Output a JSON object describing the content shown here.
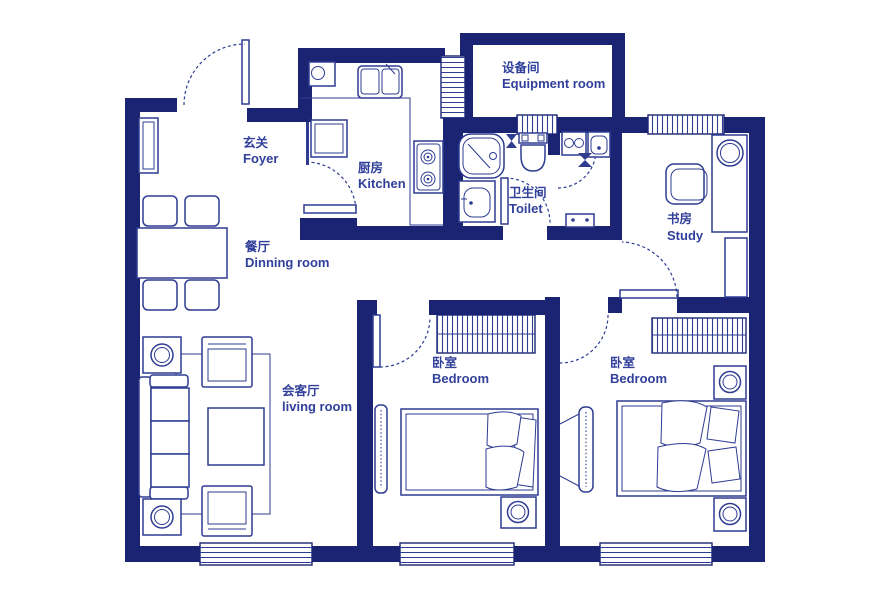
{
  "title": "apartment floor plan",
  "palette": {
    "wall": "#1a2472",
    "line": "#2e3c92",
    "text": "#31409a",
    "bg": "#ffffff"
  },
  "rooms": {
    "foyer": {
      "label_zh": "玄关",
      "label_en": "Foyer"
    },
    "kitchen": {
      "label_zh": "厨房",
      "label_en": "Kitchen"
    },
    "equipment": {
      "label_zh": "设备间",
      "label_en": "Equipment room"
    },
    "toilet": {
      "label_zh": "卫生间",
      "label_en": "Toilet"
    },
    "study": {
      "label_zh": "书房",
      "label_en": "Study"
    },
    "dining": {
      "label_zh": "餐厅",
      "label_en": "Dinning room"
    },
    "living": {
      "label_zh": "会客厅",
      "label_en": "living room"
    },
    "bedroom_mid": {
      "label_zh": "卧室",
      "label_en": "Bedroom"
    },
    "bedroom_right": {
      "label_zh": "卧室",
      "label_en": "Bedroom"
    }
  }
}
